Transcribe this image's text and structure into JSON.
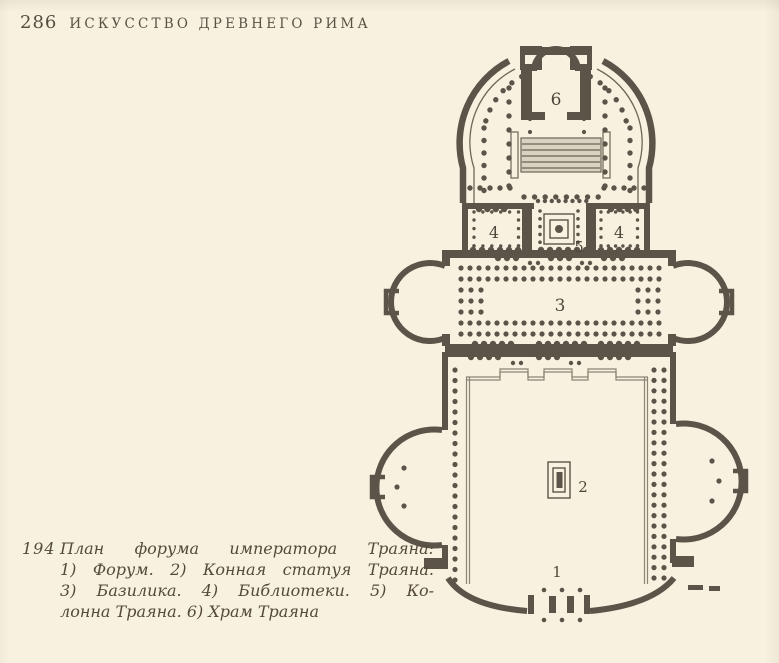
{
  "page": {
    "number": "286",
    "running_head": "ИСКУССТВО ДРЕВНЕГО РИМА",
    "background_color": "#f7f2e0",
    "ink_color": "#5d5449"
  },
  "figure": {
    "number": "194",
    "caption_lines": [
      "План  форума  императора  Траяна:",
      "1)  Форум.  2)  Конная  статуя  Траяна.",
      "3)  Базилика.  4)  Библиотеки.  5)  Ко-",
      "лонна Траяна. 6) Храм Траяна"
    ],
    "plan_labels": {
      "forum": "1",
      "statue": "2",
      "basilica": "3",
      "library_left": "4",
      "library_right": "4",
      "column": "5",
      "temple": "6"
    }
  }
}
